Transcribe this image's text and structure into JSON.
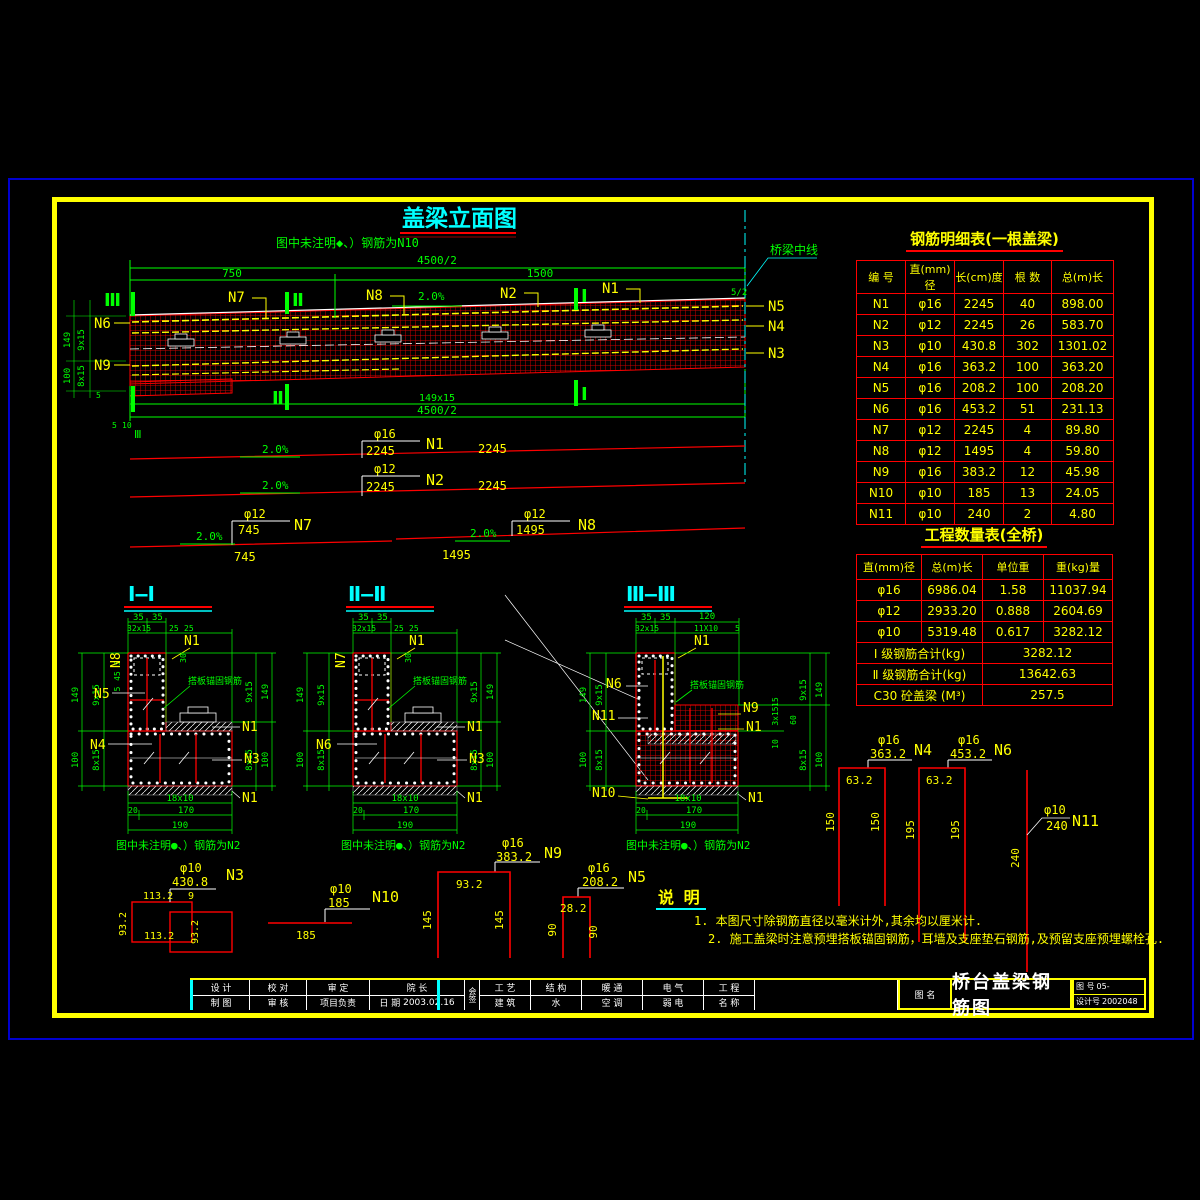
{
  "elevation": {
    "title": "盖梁立面图",
    "note": "图中未注明◆、）钢筋为N10",
    "centerline_label": "桥梁中线",
    "half_mark": "5/2",
    "slope": "2.0%",
    "dims": {
      "overall_top": "4500/2",
      "left_span": "750",
      "right_span": "1500",
      "bottom_spacing": "149x15",
      "overall_bottom": "4500/2",
      "h_upper": "149",
      "sp_upper": "9x15",
      "h_lower": "100",
      "sp_lower": "8x15",
      "d5": "5",
      "d10": "10"
    },
    "marks": {
      "s1": "Ⅰ",
      "s2": "Ⅱ",
      "s3": "Ⅲ"
    },
    "bars": {
      "n1": "N1",
      "n2": "N2",
      "n3": "N3",
      "n4": "N4",
      "n5": "N5",
      "n6": "N6",
      "n7": "N7",
      "n8": "N8",
      "n9": "N9"
    }
  },
  "bar_lines": {
    "slope": "2.0%",
    "n1": {
      "dia": "φ16",
      "len": "2245",
      "len_right": "2245",
      "label": "N1"
    },
    "n2": {
      "dia": "φ12",
      "len": "2245",
      "len_right": "2245",
      "label": "N2"
    },
    "n7": {
      "dia": "φ12",
      "len": "745",
      "len_below": "745",
      "label": "N7"
    },
    "n8": {
      "dia": "φ12",
      "len": "1495",
      "len_below": "1495",
      "label": "N8"
    }
  },
  "sections": {
    "note": "图中未注明●、）钢筋为N2",
    "anchor_note": "搭板锚固钢筋",
    "titles": {
      "s1": "Ⅰ—Ⅰ",
      "s2": "Ⅱ—Ⅱ",
      "s3": "Ⅲ—Ⅲ"
    },
    "dims": {
      "d35": "35",
      "d32x15": "32x15",
      "d25": "25",
      "d30": "30",
      "d5": "5",
      "d45": "45",
      "d149": "149",
      "d9x15": "9x15",
      "d100": "100",
      "d8x15": "8x15",
      "d18x10": "18x10",
      "d20": "20",
      "d170": "170",
      "d190": "190",
      "d120": "120",
      "d11x10": "11X10",
      "d15": "15",
      "d3x15": "3x15",
      "d60": "60",
      "d10": "10"
    },
    "labels": {
      "n1": "N1",
      "n3": "N3",
      "n4": "N4",
      "n5": "N5",
      "n6": "N6",
      "n7": "N7",
      "n8": "N8",
      "n9": "N9",
      "n10": "N10",
      "n11": "N11"
    }
  },
  "shapes": {
    "n3": {
      "dia": "φ10",
      "total": "430.8",
      "label": "N3",
      "top": "113.2",
      "side": "93.2",
      "bottom": "113.2",
      "side2": "93.2",
      "offset": "9"
    },
    "n10": {
      "dia": "φ10",
      "total": "185",
      "label": "N10",
      "len": "185"
    },
    "n9": {
      "dia": "φ16",
      "total": "383.2",
      "label": "N9",
      "top": "93.2",
      "leg": "145",
      "leg2": "145"
    },
    "n5": {
      "dia": "φ16",
      "total": "208.2",
      "label": "N5",
      "top": "28.2",
      "leg": "90",
      "leg2": "90"
    },
    "n4": {
      "dia": "φ16",
      "total": "363.2",
      "label": "N4",
      "top": "63.2",
      "leg": "150",
      "leg2": "150"
    },
    "n6": {
      "dia": "φ16",
      "total": "453.2",
      "label": "N6",
      "top": "63.2",
      "leg": "195",
      "leg2": "195"
    },
    "n11": {
      "dia": "φ10",
      "total": "240",
      "label": "N11",
      "len": "240"
    }
  },
  "notes": {
    "title": "说 明",
    "item1": "1. 本图尺寸除钢筋直径以毫米计外,其余均以厘米计.",
    "item2": "2. 施工盖梁时注意预埋搭板锚固钢筋，耳墙及支座垫石钢筋,及预留支座预埋螺栓孔."
  },
  "rebar_table": {
    "title": "钢筋明细表(一根盖梁)",
    "headers": [
      "编 号",
      "直(mm)径",
      "长(cm)度",
      "根 数",
      "总(m)长"
    ],
    "rows": [
      [
        "N1",
        "φ16",
        "2245",
        "40",
        "898.00"
      ],
      [
        "N2",
        "φ12",
        "2245",
        "26",
        "583.70"
      ],
      [
        "N3",
        "φ10",
        "430.8",
        "302",
        "1301.02"
      ],
      [
        "N4",
        "φ16",
        "363.2",
        "100",
        "363.20"
      ],
      [
        "N5",
        "φ16",
        "208.2",
        "100",
        "208.20"
      ],
      [
        "N6",
        "φ16",
        "453.2",
        "51",
        "231.13"
      ],
      [
        "N7",
        "φ12",
        "2245",
        "4",
        "89.80"
      ],
      [
        "N8",
        "φ12",
        "1495",
        "4",
        "59.80"
      ],
      [
        "N9",
        "φ16",
        "383.2",
        "12",
        "45.98"
      ],
      [
        "N10",
        "φ10",
        "185",
        "13",
        "24.05"
      ],
      [
        "N11",
        "φ10",
        "240",
        "2",
        "4.80"
      ]
    ]
  },
  "quantity_table": {
    "title": "工程数量表(全桥)",
    "headers": [
      "直(mm)径",
      "总(m)长",
      "单位重",
      "重(kg)量"
    ],
    "rows": [
      [
        "φ16",
        "6986.04",
        "1.58",
        "11037.94"
      ],
      [
        "φ12",
        "2933.20",
        "0.888",
        "2604.69"
      ],
      [
        "φ10",
        "5319.48",
        "0.617",
        "3282.12"
      ]
    ],
    "summary": [
      [
        "Ⅰ 级钢筋合计(kg)",
        "3282.12"
      ],
      [
        "Ⅱ 级钢筋合计(kg)",
        "13642.63"
      ],
      [
        "C30 砼盖梁 (M³)",
        "257.5"
      ]
    ]
  },
  "title_block": {
    "cols": [
      {
        "top": "设 计",
        "bottom": "制 图"
      },
      {
        "top": "校 对",
        "bottom": "审 核"
      },
      {
        "top": "审 定",
        "bottom": "项目负责"
      },
      {
        "top": "院 长",
        "bottom": "日 期"
      }
    ],
    "date": "2003.02.16",
    "huiqian": "会签",
    "cols2": [
      {
        "top": "工 艺",
        "bottom": "建 筑"
      },
      {
        "top": "结 构",
        "bottom": "水"
      },
      {
        "top": "暖 通",
        "bottom": "空 调"
      },
      {
        "top": "电 气",
        "bottom": "弱 电"
      },
      {
        "top": "工 程",
        "bottom": "名 称"
      }
    ],
    "drawing_name_label": "图 名",
    "drawing_name": "桥台盖梁钢筋图",
    "drawing_no_label": "图 号",
    "drawing_no": "05-",
    "design_no_label": "设计号",
    "design_no": "2002048"
  }
}
